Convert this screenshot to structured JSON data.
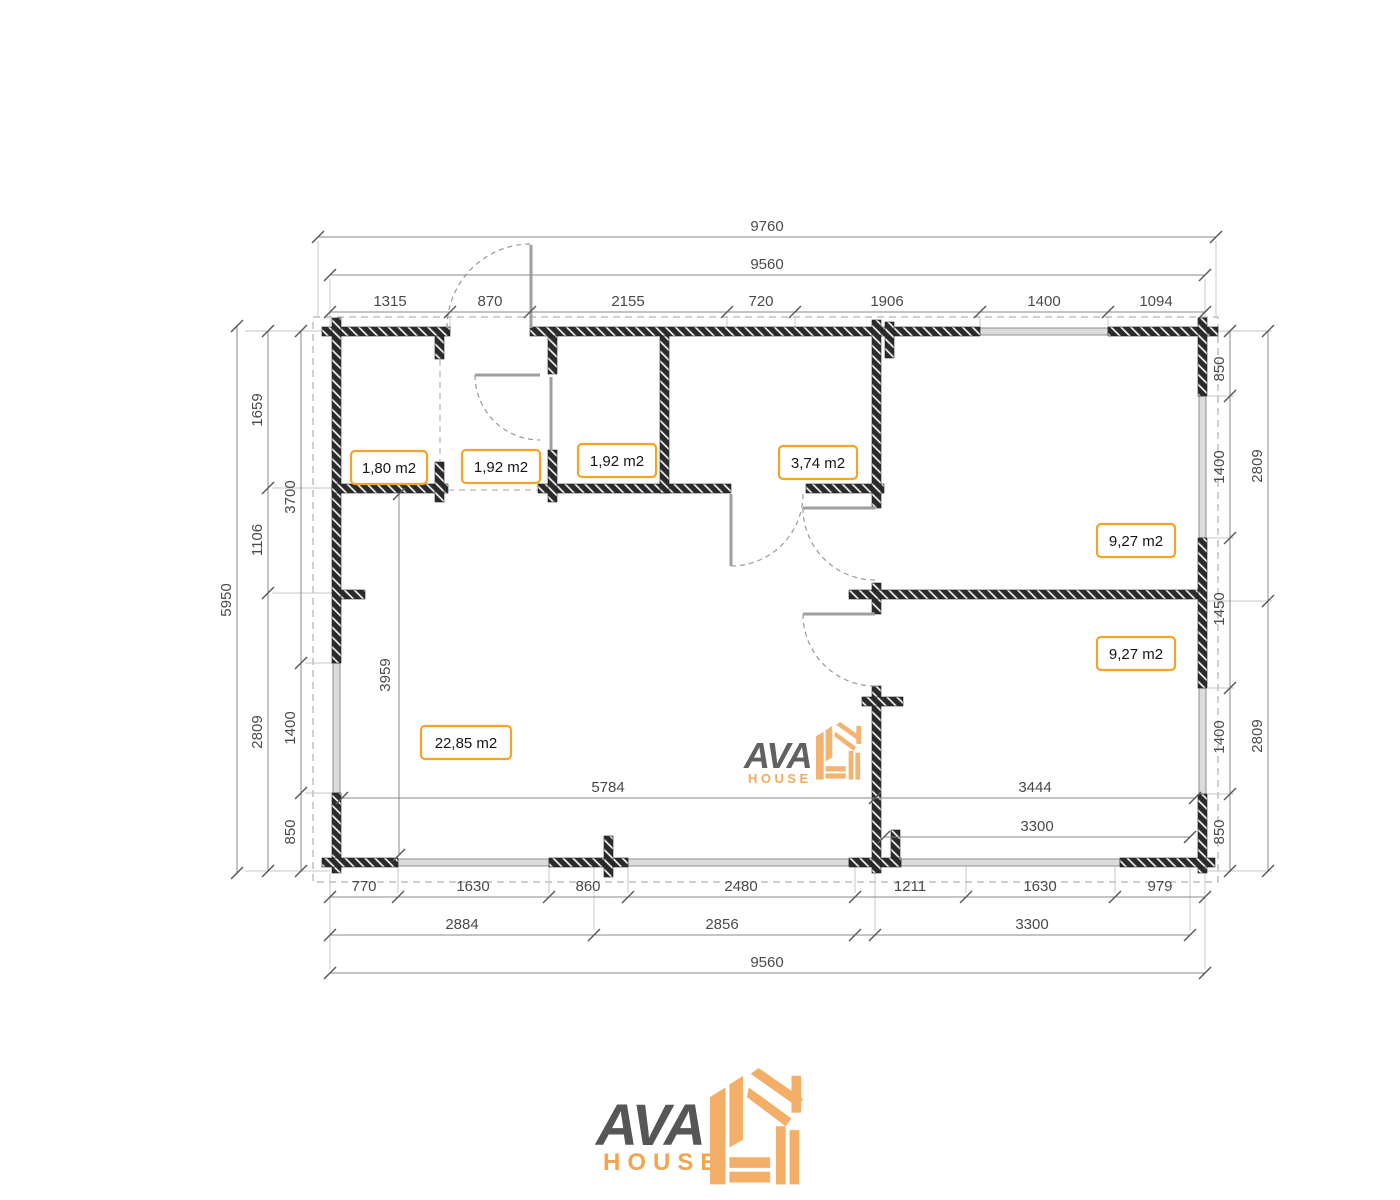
{
  "drawing": {
    "dims": {
      "top": {
        "outer": "9760",
        "inner": "9560",
        "seg": [
          "1315",
          "870",
          "2155",
          "720",
          "1906",
          "1400",
          "1094"
        ]
      },
      "left": {
        "total": "5950",
        "chain_inner": [
          "1659",
          "1106",
          "2809"
        ],
        "chain_outer": [
          "3700",
          "1400",
          "850"
        ]
      },
      "right": {
        "chain": [
          "850",
          "1400",
          "1450",
          "1400",
          "850"
        ],
        "outer": [
          "2809",
          "2809"
        ]
      },
      "bottom": {
        "seg": [
          "770",
          "1630",
          "860",
          "2480",
          "1211",
          "1630",
          "979"
        ],
        "chain": [
          "2884",
          "2856",
          "3300"
        ],
        "total": "9560"
      },
      "interior": {
        "living_width": "5784",
        "right_width": "3444",
        "bedroom_width": "3300",
        "living_height": "3959"
      }
    },
    "rooms": [
      {
        "area": "1,80 m2"
      },
      {
        "area": "1,92 m2"
      },
      {
        "area": "1,92 m2"
      },
      {
        "area": "3,74 m2"
      },
      {
        "area": "9,27 m2"
      },
      {
        "area": "9,27 m2"
      },
      {
        "area": "22,85 m2"
      }
    ]
  },
  "branding": {
    "name": "AVA",
    "sub": "HOUSE"
  },
  "colors": {
    "accent": "#F5A428",
    "logo_orange": "#F2AC64",
    "logo_gray": "#545454",
    "wall": "#2b2b2b",
    "dim_text": "#4a4a4a",
    "dim_line": "#8a8a8a"
  }
}
